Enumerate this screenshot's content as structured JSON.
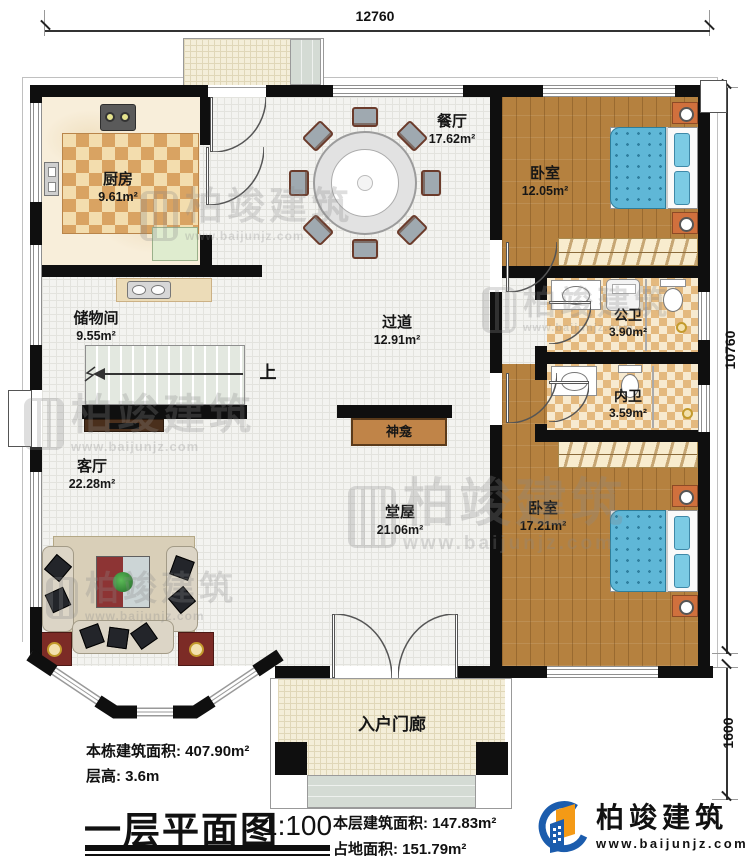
{
  "dimensions": {
    "top": "12760",
    "right_main": "10760",
    "right_porch": "1600"
  },
  "rooms": {
    "kitchen": {
      "name": "厨房",
      "area": "9.61m²"
    },
    "dining": {
      "name": "餐厅",
      "area": "17.62m²"
    },
    "bedroom1": {
      "name": "卧室",
      "area": "12.05m²"
    },
    "storage": {
      "name": "储物间",
      "area": "9.55m²"
    },
    "hallway": {
      "name": "过道",
      "area": "12.91m²"
    },
    "public_bath": {
      "name": "公卫",
      "area": "3.90m²"
    },
    "ensuite_bath": {
      "name": "内卫",
      "area": "3.59m²"
    },
    "living": {
      "name": "客厅",
      "area": "22.28m²"
    },
    "main_hall": {
      "name": "堂屋",
      "area": "21.06m²"
    },
    "bedroom2": {
      "name": "卧室",
      "area": "17.21m²"
    },
    "entry_porch": {
      "name": "入户门廊"
    }
  },
  "annotations": {
    "stairs_up": "上",
    "shrine": "神龛"
  },
  "footer": {
    "total_area_label": "本栋建筑面积:",
    "total_area_value": "407.90m²",
    "floor_height_label": "层高:",
    "floor_height_value": "3.6m",
    "title": "一层平面图",
    "scale": "1:100",
    "floor_area_label": "本层建筑面积:",
    "floor_area_value": "147.83m²",
    "footprint_label": "占地面积:",
    "footprint_value": "151.79m²"
  },
  "branding": {
    "logo_text": "柏竣建筑",
    "logo_url": "www.baijunjz.com",
    "watermark_text": "柏竣建筑",
    "watermark_url": "www.baijunjz.com",
    "logo_blue": "#1b5cad",
    "logo_orange": "#f49a16"
  }
}
